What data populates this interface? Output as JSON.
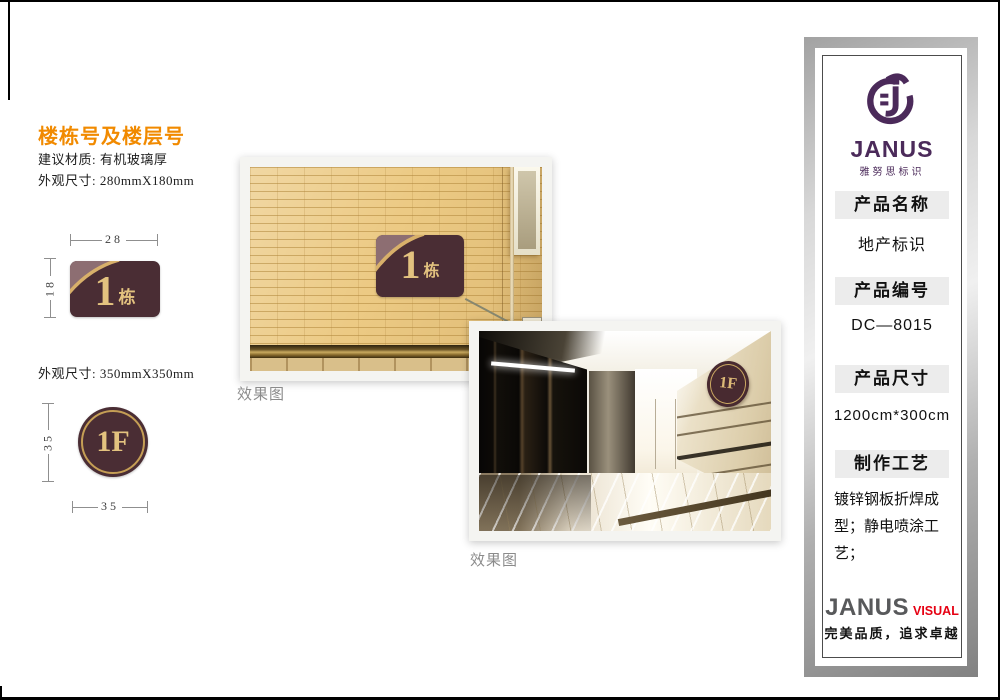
{
  "page": {
    "title": "楼栋号及楼层号",
    "material_line": "建议材质: 有机玻璃厚",
    "size_line_1": "外观尺寸: 280mmX180mm",
    "size_line_2": "外观尺寸: 350mmX350mm"
  },
  "building_sign": {
    "number": "1",
    "suffix": "栋",
    "dim_width": "28",
    "dim_height": "18"
  },
  "floor_sign": {
    "label": "1F",
    "dim_width": "35",
    "dim_height": "35"
  },
  "photos": {
    "photo1_caption": "效果图",
    "photo1_sign_number": "1",
    "photo1_sign_suffix": "栋",
    "photo2_caption": "效果图",
    "photo2_sign_label": "1F"
  },
  "panel": {
    "brand": "JANUS",
    "brand_subtitle": "雅努思标识",
    "sections": [
      {
        "header": "产品名称",
        "value": "地产标识"
      },
      {
        "header": "产品编号",
        "value": "DC—8015"
      },
      {
        "header": "产品尺寸",
        "value": "1200cm*300cm"
      },
      {
        "header": "制作工艺",
        "value": "镀锌钢板折焊成型；静电喷涂工艺；"
      }
    ],
    "footer_brand": "JANUS",
    "footer_brand_suffix": "VISUAL",
    "slogan": "完美品质，追求卓越"
  },
  "colors": {
    "accent_orange": "#F18A00",
    "sign_brown": "#4A2D34",
    "sign_gold": "#D8B06A",
    "sign_text_gold": "#E3C27F",
    "brand_purple": "#4B2A5A",
    "brand_red": "#E60012",
    "band_gray": "#ECECEC"
  }
}
